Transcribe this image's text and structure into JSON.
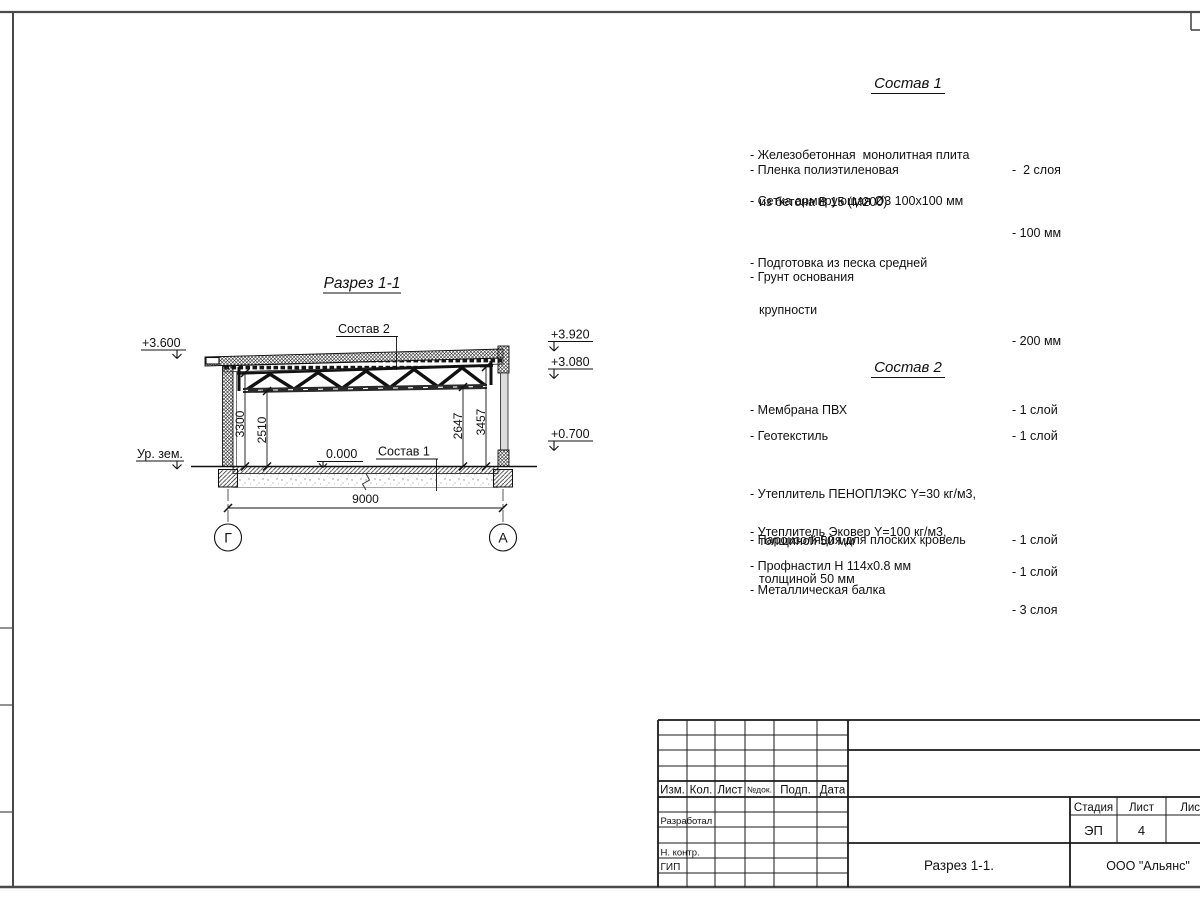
{
  "drawing": {
    "title": "Разрез 1-1",
    "sostav1_ref": "Состав 1",
    "sostav2_ref": "Состав 2",
    "zero_level": "0.000",
    "ground_label": "Ур. зем.",
    "elev_left_top": "+3.600",
    "elev_right_top": "+3.920",
    "elev_right_mid": "+3.080",
    "elev_right_low": "+0.700",
    "dim_3300": "3300",
    "dim_2510": "2510",
    "dim_2647": "2647",
    "dim_3457": "3457",
    "dim_span": "9000",
    "axis_left": "Г",
    "axis_right": "А"
  },
  "compositions": {
    "c1": {
      "title": "Состав 1",
      "items": [
        {
          "name": "- Железобетонная  монолитная плита",
          "name2": "из бетона В 15 (М200)",
          "value": "- 100 мм"
        },
        {
          "name": "- Пленка полиэтиленовая",
          "value": "-  2 слоя"
        },
        {
          "name": "- Сетка армирующая Ø3 100х100 мм",
          "value": ""
        },
        {
          "name": "- Подготовка из песка средней",
          "name2": "крупности",
          "value": "- 200 мм"
        },
        {
          "name": "- Грунт основания",
          "value": ""
        }
      ]
    },
    "c2": {
      "title": "Состав 2",
      "items": [
        {
          "name": "- Мембрана ПВХ",
          "value": "- 1 слой"
        },
        {
          "name": "- Геотекстиль",
          "value": "- 1 слой"
        },
        {
          "name": "- Утеплитель ПЕНОПЛЭКС Y=30 кг/м3,",
          "name2": "толщиной 50 мм",
          "value": "- 1 слой"
        },
        {
          "name": "- Утеплитель Эковер Y=100 кг/м3,",
          "name2": "толщиной 50 мм",
          "value": "- 3 слоя"
        },
        {
          "name": "- Пароизоляция для плоских кровель",
          "value": "- 1 слой"
        },
        {
          "name": "- Профнастил Н 114х0.8 мм",
          "value": ""
        },
        {
          "name": "- Металлическая балка",
          "value": ""
        }
      ]
    }
  },
  "titleblock": {
    "col_izm": "Изм.",
    "col_kol": "Кол.",
    "col_list": "Лист",
    "col_doc": "№док.",
    "col_podp": "Подп.",
    "col_data": "Дата",
    "row_developed": "Разработал",
    "row_ncontr": "Н. контр.",
    "row_gip": "ГИП",
    "stage_label": "Стадия",
    "sheet_label": "Лист",
    "sheets_label": "Листов",
    "stage_value": "ЭП",
    "sheet_value": "4",
    "doc_title": "Разрез 1-1.",
    "company": "ООО \"Альянс\""
  }
}
